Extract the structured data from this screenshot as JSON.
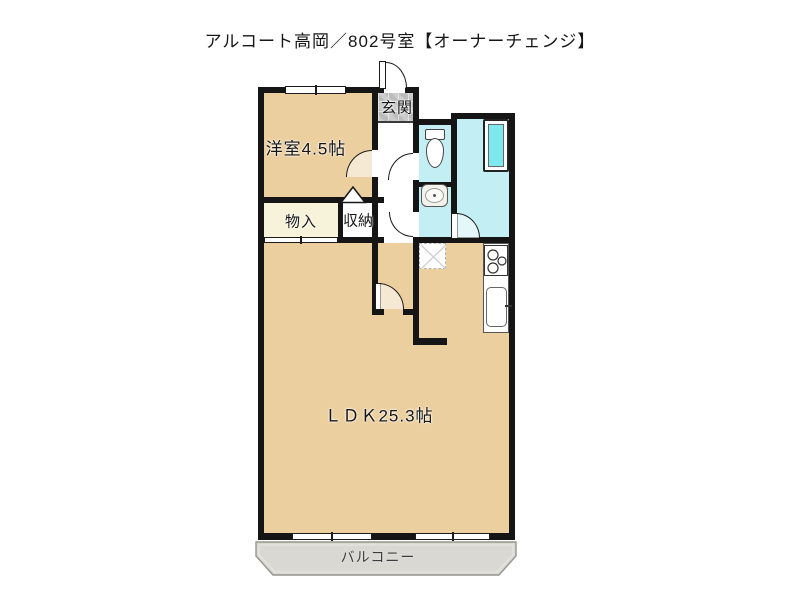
{
  "title": "アルコート高岡／802号室【オーナーチェンジ】",
  "floorplan": {
    "rooms": {
      "entrance": {
        "label": "玄関"
      },
      "western_room": {
        "label": "洋室4.5帖"
      },
      "storage": {
        "label": "物入"
      },
      "closet": {
        "label": "収納"
      },
      "ldk": {
        "label": "ＬＤＫ25.3帖"
      },
      "balcony": {
        "label": "バルコニー"
      }
    },
    "fixtures": [
      "toilet",
      "washbasin",
      "bathtub",
      "gas-stove",
      "kitchen-sink",
      "refrigerator-space",
      "closet-door-triangle"
    ],
    "colors": {
      "wall": "#151515",
      "wood_floor": "#eccf9f",
      "wet_area": "#c3eef4",
      "bathtub_water": "#7ee8ef",
      "storage_fill": "#f7f3da",
      "entrance_tile": "#c7c7c7",
      "balcony_gray": "#d9d8d2"
    }
  }
}
